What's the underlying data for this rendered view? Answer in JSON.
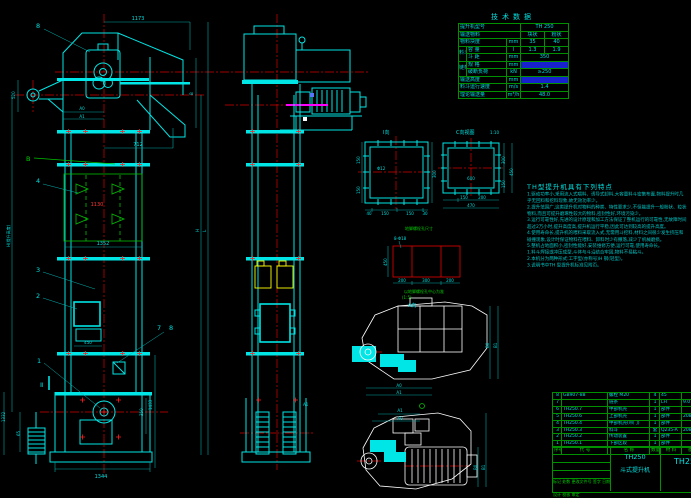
{
  "tech_table": {
    "title": "技术数据",
    "model_label": "提升机型号",
    "model_value": "TH 250",
    "material_label": "输送物料",
    "material_v1": "块状",
    "material_v2": "粉状",
    "lump_label": "物料块度",
    "lump_unit": "mm",
    "lump_v1": "35",
    "lump_v2": "40",
    "bucket_group": "料斗",
    "cap_label": "容 量",
    "cap_unit": "l",
    "cap_v1": "1.3",
    "cap_v2": "1.9",
    "pitch_label": "斗 距",
    "pitch_unit": "mm",
    "pitch_value": "350",
    "chain_group": "链条",
    "spec_label": "规 格",
    "spec_unit": "mm",
    "spec_value": "",
    "break_label": "破断负荷",
    "break_unit": "kN",
    "break_value": "≥250",
    "height_label": "输送高度",
    "height_unit": "mm",
    "height_value": "",
    "speed_label": "料斗运行速度",
    "speed_unit": "m/s",
    "speed_value": "1.4",
    "capacity_label": "理论输送量",
    "capacity_unit": "m³/h",
    "capacity_value": "48.0"
  },
  "notes": {
    "title": "TH型提升机具有下列特点",
    "lines": [
      "1.驱动功率小,采用流入式喂料、诱导式卸料,大容量料斗密集布置,物料提升时几",
      "  乎无回料和挖料现象,故无效功率少。",
      "2.提升范围广,这类提升机对物料的种类、特性要求少,不但能提升一般粉状、粒状",
      "  物料,而且可提升磨琢性较大的物料,密封性好,环境污染少。",
      "3.运行可靠性好,先进的设计原理和加工方法保证了整机运行的可靠性,无故障时间",
      "  超过2万小时,提升高度高,提升机运行平稳,因此可达到较高的提升高度。",
      "4.使用寿命长,提升机的喂料采取流入式,无需用斗挖料,材料之间很少发生挤压和",
      "  碰撞现象,设计时保证物料在喂料、卸料时少有撒落,减少了机械磨损。",
      "5.整机占地面积小,密封性能好,安装维修方便,运行可靠,使用寿命长。",
      "",
      "1.料斗焊接或冲压成型,斗体与斗沿结合牢固,物料不易粘斗。",
      "2.本机分为两种形式:工字型(亦称号)H 钢(轻型)。",
      "",
      "3.说明书中TH 型提升机标准见附页。"
    ]
  },
  "bom": {
    "rows": [
      {
        "seq": "8",
        "code": "GB907-88",
        "name": "螺栓 M20",
        "qty": "4",
        "mat": "45",
        "rem": ""
      },
      {
        "seq": "7",
        "code": "",
        "name": "链条",
        "qty": "1",
        "mat": "LH",
        "rem": "9.0"
      },
      {
        "seq": "6",
        "code": "TH250.7",
        "name": "中部机壳",
        "qty": "1",
        "mat": "部件",
        "rem": ""
      },
      {
        "seq": "5",
        "code": "TH250.6",
        "name": "上部机壳",
        "qty": "1",
        "mat": "部件",
        "rem": "208"
      },
      {
        "seq": "4",
        "code": "TH250.4",
        "name": "中部机壳(带门)",
        "qty": "1",
        "mat": "部件",
        "rem": ""
      },
      {
        "seq": "3",
        "code": "TH250.3",
        "name": "料斗",
        "qty": "套",
        "mat": "Q235-A",
        "rem": "208"
      },
      {
        "seq": "2",
        "code": "TH250.2",
        "name": "传动装置",
        "qty": "1",
        "mat": "部件",
        "rem": ""
      },
      {
        "seq": "1",
        "code": "TH250.1",
        "name": "下部区段",
        "qty": "1",
        "mat": "部件",
        "rem": ""
      }
    ],
    "header": {
      "seq": "序号",
      "code": "代 号",
      "name": "名 称",
      "qty": "数量",
      "mat": "材 料",
      "rem": "备注"
    }
  },
  "title_block": {
    "model": "TH250",
    "product": "斗式提升机",
    "right_code": "TH250",
    "sign_row1": "标记 处数 更改文件号 签字 日期",
    "sign_row2": "设计    校核    审定"
  },
  "labels": {
    "d1173": "1173",
    "d712": "712",
    "dA0": "A0",
    "dA1": "A1",
    "d520": "520",
    "dB": "B",
    "dH": "H",
    "dL": "L",
    "height_note": "H(提升高度)",
    "d1130": "1130",
    "d1352": "1352",
    "d450": "450",
    "d1433": "1433",
    "d350": "350",
    "d1344": "1344",
    "d65": "65",
    "d1332": "1332",
    "b8": "8",
    "b4": "4",
    "b3": "3",
    "b2": "2",
    "b1": "1",
    "b7": "7",
    "b8b": "8",
    "bB": "B",
    "sec2": "Ⅱ",
    "sA1": "A1",
    "v1_cap": "Ⅰ向",
    "f1_hole": "Φ12",
    "f1_l1": "150",
    "f1_l2": "150",
    "f1_r": "300",
    "f1_b1": "40",
    "f1_b2": "150",
    "f1_b3": "150",
    "f1_b4": "30",
    "v2_cap": "C向视图",
    "v2_scale": "1:10",
    "f2_c": "600",
    "f2_b1": "150",
    "f2_b2": "200",
    "f2_b3": "470",
    "f2_r1": "300",
    "f2_r2": "150",
    "f2_r3": "450",
    "anchor_cap": "地脚螺栓孔尺寸",
    "anchor_hole": "8-Φ18",
    "anchor_l": "450",
    "anchor_b1": "200",
    "anchor_b2": "300",
    "anchor_b3": "200",
    "anchor_note1": "以地脚螺栓孔中心为准",
    "anchor_note2": "(1:5)",
    "vA_cap": "A向",
    "u_a0": "A0",
    "u_a1": "A1",
    "u_b0": "B0",
    "u_b1": "B1",
    "l_a1": "A1",
    "l_a0": "A0",
    "l_b0": "B0",
    "l_b1": "B1"
  }
}
